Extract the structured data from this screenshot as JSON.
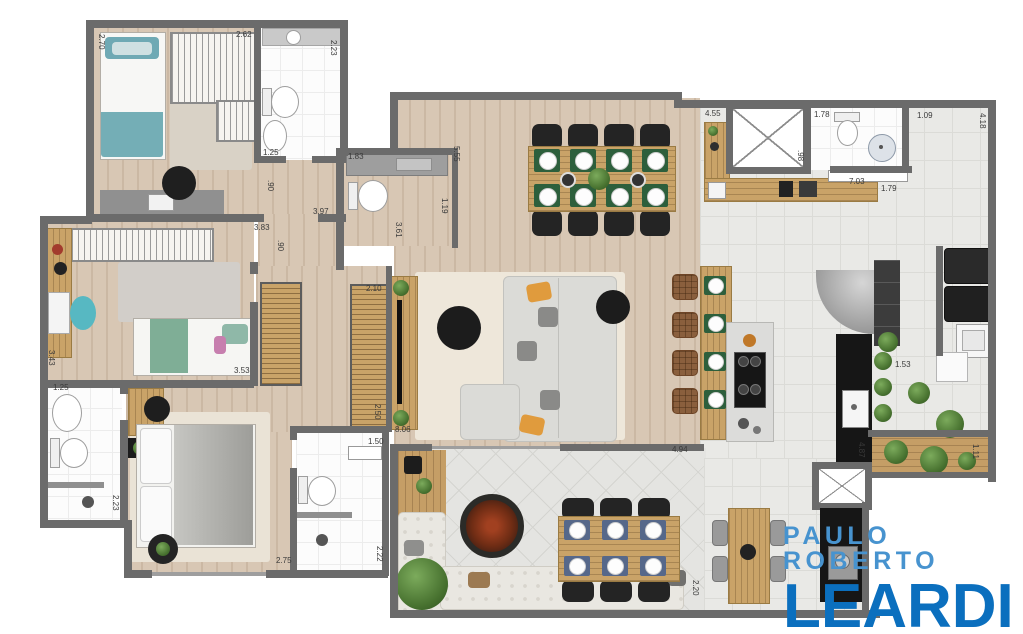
{
  "brand": {
    "line1": "PAULO ROBERTO",
    "line2": "LEARDI",
    "color1": "#4793CF",
    "color2": "#0B6FBE"
  },
  "colors": {
    "wall": "#6b6b6b",
    "wood_floor": "#d8c7b4",
    "white_tile": "#fcfcfc",
    "gray_tile": "#e9e9e6",
    "deck_wood": "#c59e66",
    "cabinet_wood": "#c9a368",
    "teal_accent": "#58b7c0",
    "green_mat": "#2d5f3c",
    "blue_mat": "#56688a"
  },
  "dimensions": [
    {
      "t": "2.70",
      "x": 97,
      "y": 34,
      "v": true
    },
    {
      "t": "2.62",
      "x": 236,
      "y": 30,
      "v": false
    },
    {
      "t": "2.23",
      "x": 329,
      "y": 40,
      "v": true
    },
    {
      "t": "1.25",
      "x": 263,
      "y": 148,
      "v": false
    },
    {
      "t": ".90",
      "x": 266,
      "y": 180,
      "v": true
    },
    {
      "t": "3.97",
      "x": 313,
      "y": 207,
      "v": false
    },
    {
      "t": "3.83",
      "x": 254,
      "y": 223,
      "v": false
    },
    {
      "t": ".90",
      "x": 276,
      "y": 240,
      "v": true
    },
    {
      "t": "1.83",
      "x": 348,
      "y": 152,
      "v": false
    },
    {
      "t": "5.55",
      "x": 452,
      "y": 146,
      "v": true
    },
    {
      "t": "1.19",
      "x": 440,
      "y": 198,
      "v": true
    },
    {
      "t": "3.61",
      "x": 394,
      "y": 222,
      "v": true
    },
    {
      "t": "4.55",
      "x": 705,
      "y": 109,
      "v": false
    },
    {
      "t": "1.78",
      "x": 814,
      "y": 110,
      "v": false
    },
    {
      "t": ".98",
      "x": 796,
      "y": 150,
      "v": true
    },
    {
      "t": "7.03",
      "x": 849,
      "y": 177,
      "v": false
    },
    {
      "t": "1.79",
      "x": 881,
      "y": 184,
      "v": false
    },
    {
      "t": "1.09",
      "x": 917,
      "y": 111,
      "v": false
    },
    {
      "t": "4.18",
      "x": 978,
      "y": 113,
      "v": true
    },
    {
      "t": "2.10",
      "x": 366,
      "y": 284,
      "v": false
    },
    {
      "t": "2.50",
      "x": 373,
      "y": 404,
      "v": true
    },
    {
      "t": "1.50",
      "x": 368,
      "y": 437,
      "v": false
    },
    {
      "t": "3.53",
      "x": 234,
      "y": 366,
      "v": false
    },
    {
      "t": "3.43",
      "x": 47,
      "y": 350,
      "v": true
    },
    {
      "t": "1.25",
      "x": 53,
      "y": 383,
      "v": false
    },
    {
      "t": "2.23",
      "x": 111,
      "y": 495,
      "v": true
    },
    {
      "t": "2.75",
      "x": 276,
      "y": 556,
      "v": false
    },
    {
      "t": "2.22",
      "x": 375,
      "y": 546,
      "v": true
    },
    {
      "t": "8.06",
      "x": 395,
      "y": 425,
      "v": false
    },
    {
      "t": "4.94",
      "x": 672,
      "y": 445,
      "v": false
    },
    {
      "t": "4.87",
      "x": 857,
      "y": 442,
      "v": true
    },
    {
      "t": "1.53",
      "x": 895,
      "y": 360,
      "v": false
    },
    {
      "t": "1.11",
      "x": 971,
      "y": 444,
      "v": true
    },
    {
      "t": "2.20",
      "x": 691,
      "y": 580,
      "v": true
    }
  ]
}
